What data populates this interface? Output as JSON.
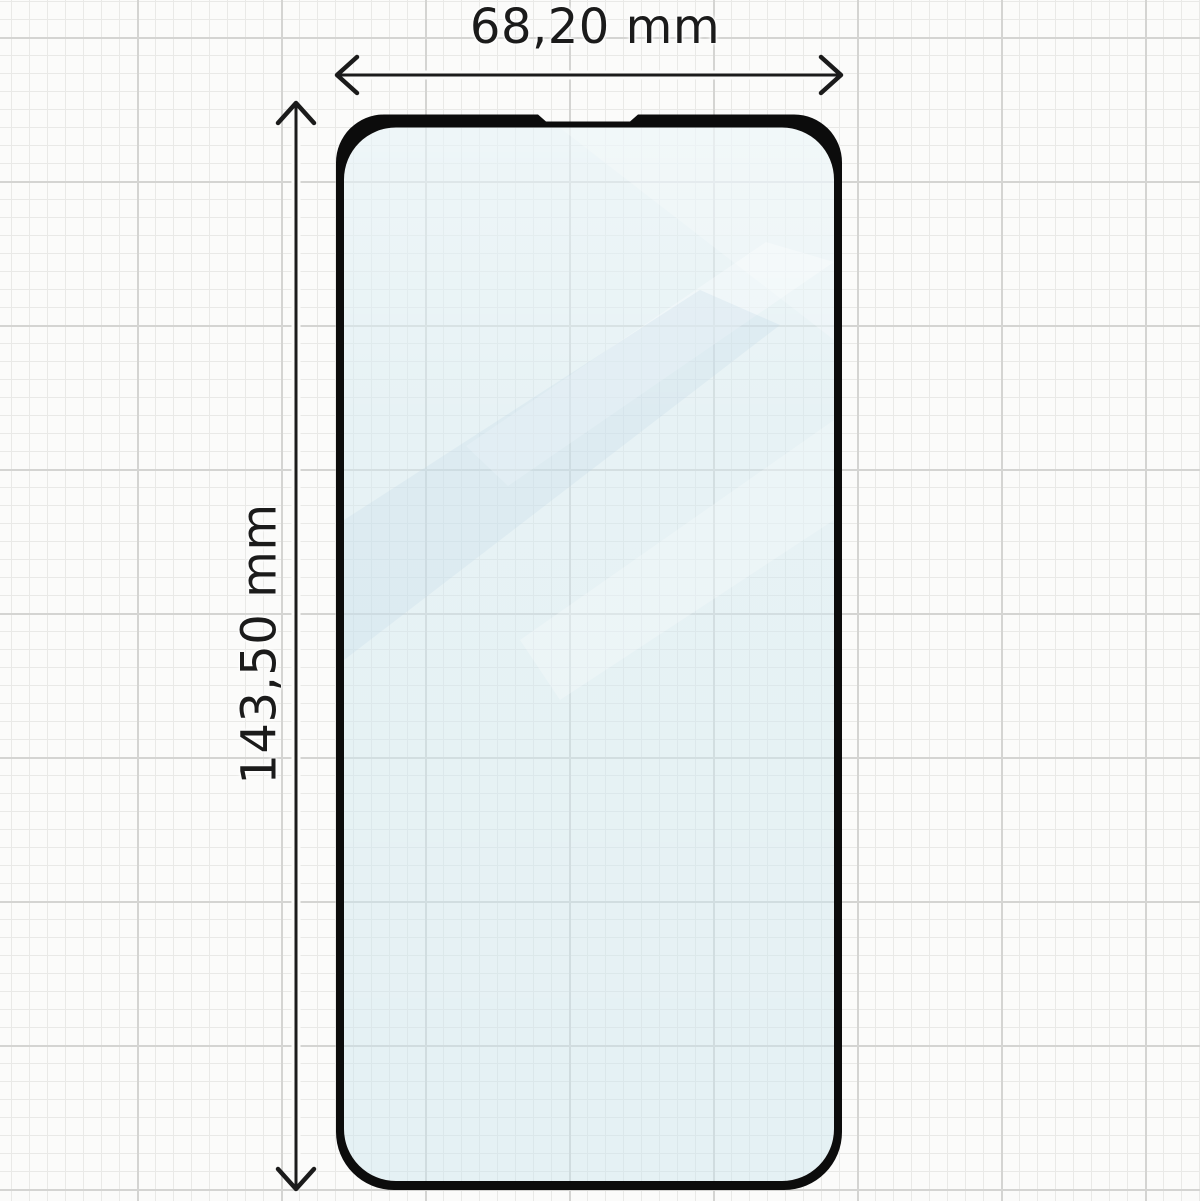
{
  "diagram": {
    "type": "screen-protector-dimension-drawing",
    "width_dimension": {
      "label": "68,20 mm"
    },
    "height_dimension": {
      "label": "143,50 mm"
    }
  },
  "colors": {
    "background": "#fbfbfa",
    "grid_minor": "#e9e9e7",
    "grid_major": "#d4d4d2",
    "outline_black": "#0c0c0c",
    "glass_tint": "#cde5ef",
    "glass_reflection": "#ffffff",
    "dimension_ink": "#1b1b1b"
  }
}
